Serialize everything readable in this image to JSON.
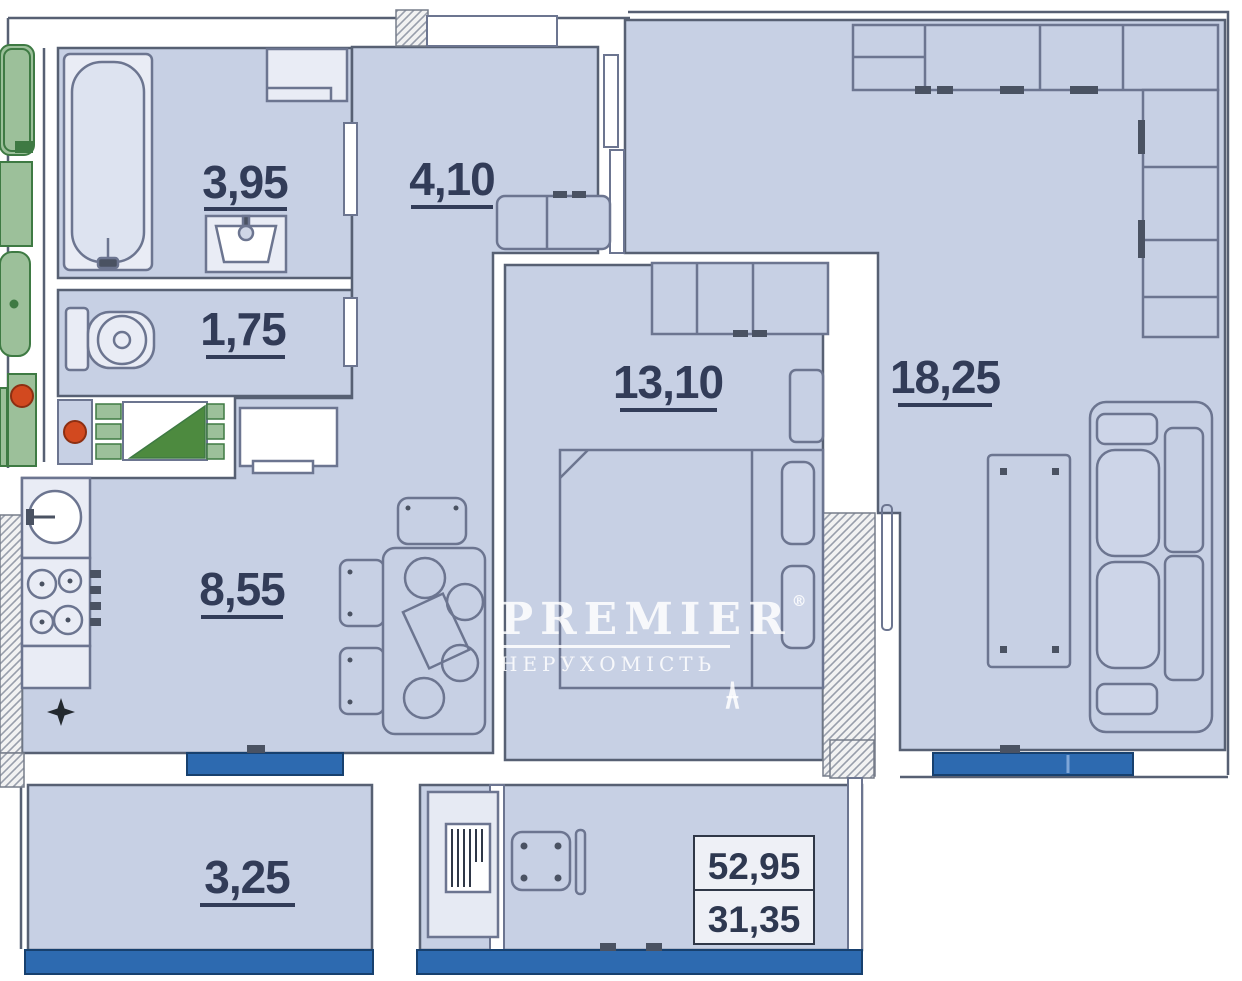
{
  "plan": {
    "type": "apartment-floor-plan",
    "watermark": {
      "brand": "PREMIER",
      "registered": "®",
      "subtitle": "НЕРУХОМІСТЬ"
    },
    "rooms": {
      "bathroom": {
        "area": "3,95"
      },
      "hallway": {
        "area": "4,10"
      },
      "toilet": {
        "area": "1,75"
      },
      "bedroom": {
        "area": "13,10"
      },
      "living_room": {
        "area": "18,25"
      },
      "kitchen": {
        "area": "8,55"
      },
      "balcony": {
        "area": "3,25"
      }
    },
    "area_box": {
      "total_area": "52,95",
      "living_area": "31,35"
    },
    "colors": {
      "room_fill": "#c7d0e4",
      "wall_stroke": "#576073",
      "furniture_stroke": "#6c7590",
      "window_blue": "#2d6ab0",
      "neighbor_green": "#9cc09a",
      "accent_orange": "#d2491f",
      "label_navy": "#323c58"
    }
  }
}
